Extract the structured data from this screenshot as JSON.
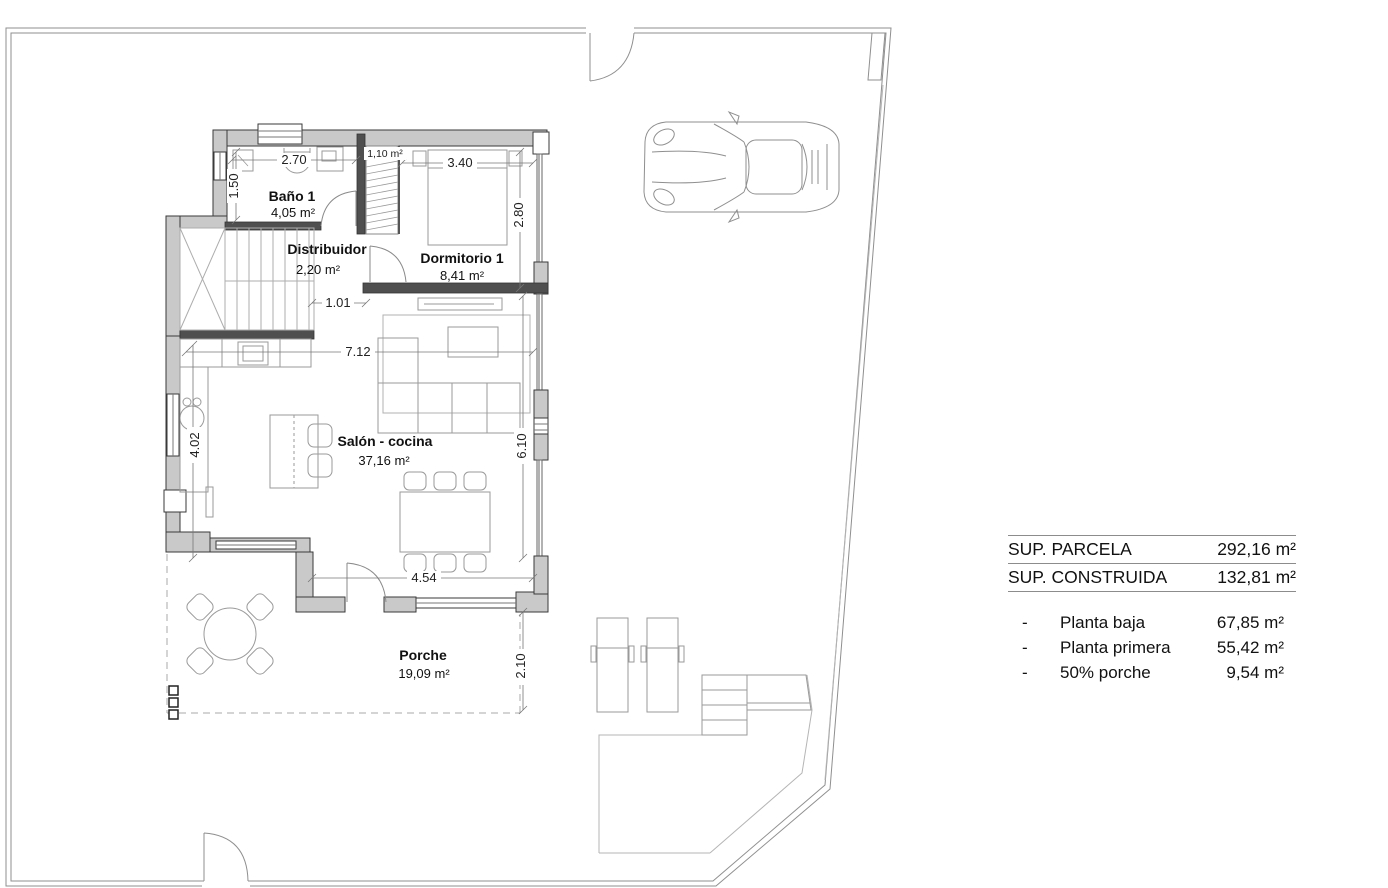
{
  "plan": {
    "rooms": [
      {
        "name": "Baño 1",
        "area": "4,05 m²"
      },
      {
        "name": "Distribuidor",
        "area": "2,20 m²"
      },
      {
        "name": "Dormitorio 1",
        "area": "8,41 m²"
      },
      {
        "name": "Salón - cocina",
        "area": "37,16 m²"
      },
      {
        "name": "Porche",
        "area": "19,09 m²"
      }
    ],
    "closet_area": "1,10 m²",
    "dims": {
      "bath_width": "2.70",
      "bath_height": "1.50",
      "bedroom_width": "3.40",
      "bedroom_height": "2.80",
      "hall_opening": "1.01",
      "salon_width": "7.12",
      "kitchen_height": "4.02",
      "salon_height": "6.10",
      "porch_width": "4.54",
      "porch_height": "2.10"
    }
  },
  "summary": {
    "rows": [
      {
        "label": "SUP. PARCELA",
        "value": "292,16 m²"
      },
      {
        "label": "SUP. CONSTRUIDA",
        "value": "132,81 m²"
      }
    ],
    "breakdown": [
      {
        "bullet": "-",
        "label": "Planta baja",
        "value": "67,85 m²"
      },
      {
        "bullet": "-",
        "label": "Planta primera",
        "value": "55,42 m²"
      },
      {
        "bullet": "-",
        "label": "50% porche",
        "value": "9,54 m²"
      }
    ]
  },
  "colors": {
    "wall_fill": "#c9c9c9",
    "wall_dark": "#4f4f4f",
    "wall_stroke": "#3a3a3a",
    "furniture_line": "#9a9a9a",
    "boundary_line": "#8f8f8f",
    "dim_text": "#222222",
    "background": "#ffffff"
  }
}
